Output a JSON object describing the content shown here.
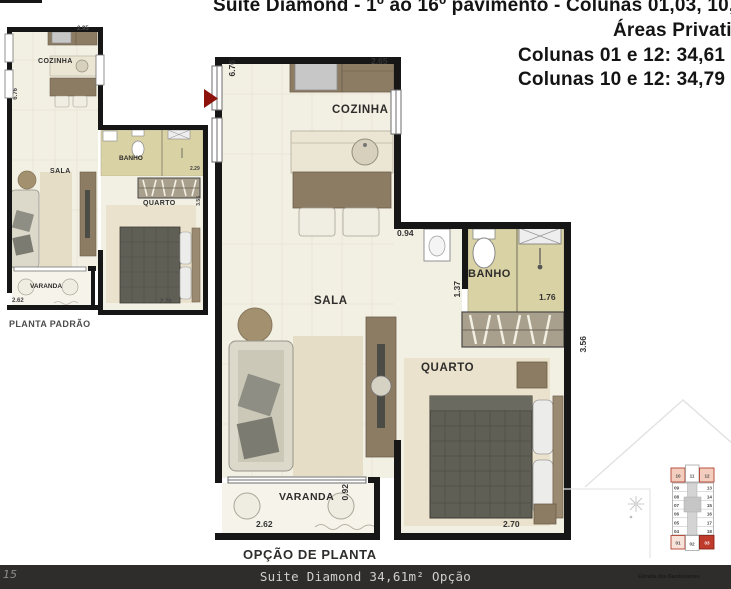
{
  "header": {
    "line1": "Suíte Diamond - 1º ao 16º pavimento - Colunas 01,03, 10,",
    "line2": "Áreas Privativ",
    "line3": "Colunas 01 e 12: 34,61",
    "line4": "Colunas 10 e 12: 34,79"
  },
  "plan_padrao": {
    "caption": "PLANTA PADRÃO",
    "rooms": {
      "cozinha": "COZINHA",
      "sala": "SALA",
      "banho": "BANHO",
      "quarto": "QUARTO",
      "varanda": "VARANDA"
    },
    "dims": {
      "top": "2.95",
      "left": "6.76",
      "banho_right": "2.29",
      "quarto_right": "3.56",
      "varanda_bottom": "2.62",
      "quarto_bottom": "2.70"
    }
  },
  "plan_opcao": {
    "caption": "OPÇÃO DE PLANTA",
    "rooms": {
      "cozinha": "COZINHA",
      "sala": "SALA",
      "banho": "BANHO",
      "quarto": "QUARTO",
      "varanda": "VARANDA"
    },
    "dims": {
      "top": "2.65",
      "left": "6.76",
      "lavabo": "0.94",
      "banho_left": "1.37",
      "banho_right": "1.76",
      "quarto_right": "3.56",
      "varanda_right": "0.92",
      "varanda_bottom": "2.62",
      "quarto_bottom": "2.70"
    }
  },
  "siteplan": {
    "units": [
      "10",
      "11",
      "12",
      "09",
      "08",
      "07",
      "06",
      "05",
      "04",
      "13",
      "14",
      "15",
      "16",
      "17",
      "18",
      "01",
      "02",
      "03"
    ],
    "highlighted_units": [
      "10",
      "12",
      "01",
      "03"
    ],
    "highlight_color": "#bf3b2b"
  },
  "footer": {
    "page_number": "15",
    "bar_text": "Suite Diamond 34,61m² Opção",
    "watermark": "Estrada dos Bandeirantes"
  },
  "colors": {
    "wall": "#161616",
    "bath_floor": "#d9d2a4",
    "wood": "#8d7c64",
    "floor": "#f2efe3",
    "bar_bg": "#2e2d2b",
    "arrow": "#8c120b"
  }
}
